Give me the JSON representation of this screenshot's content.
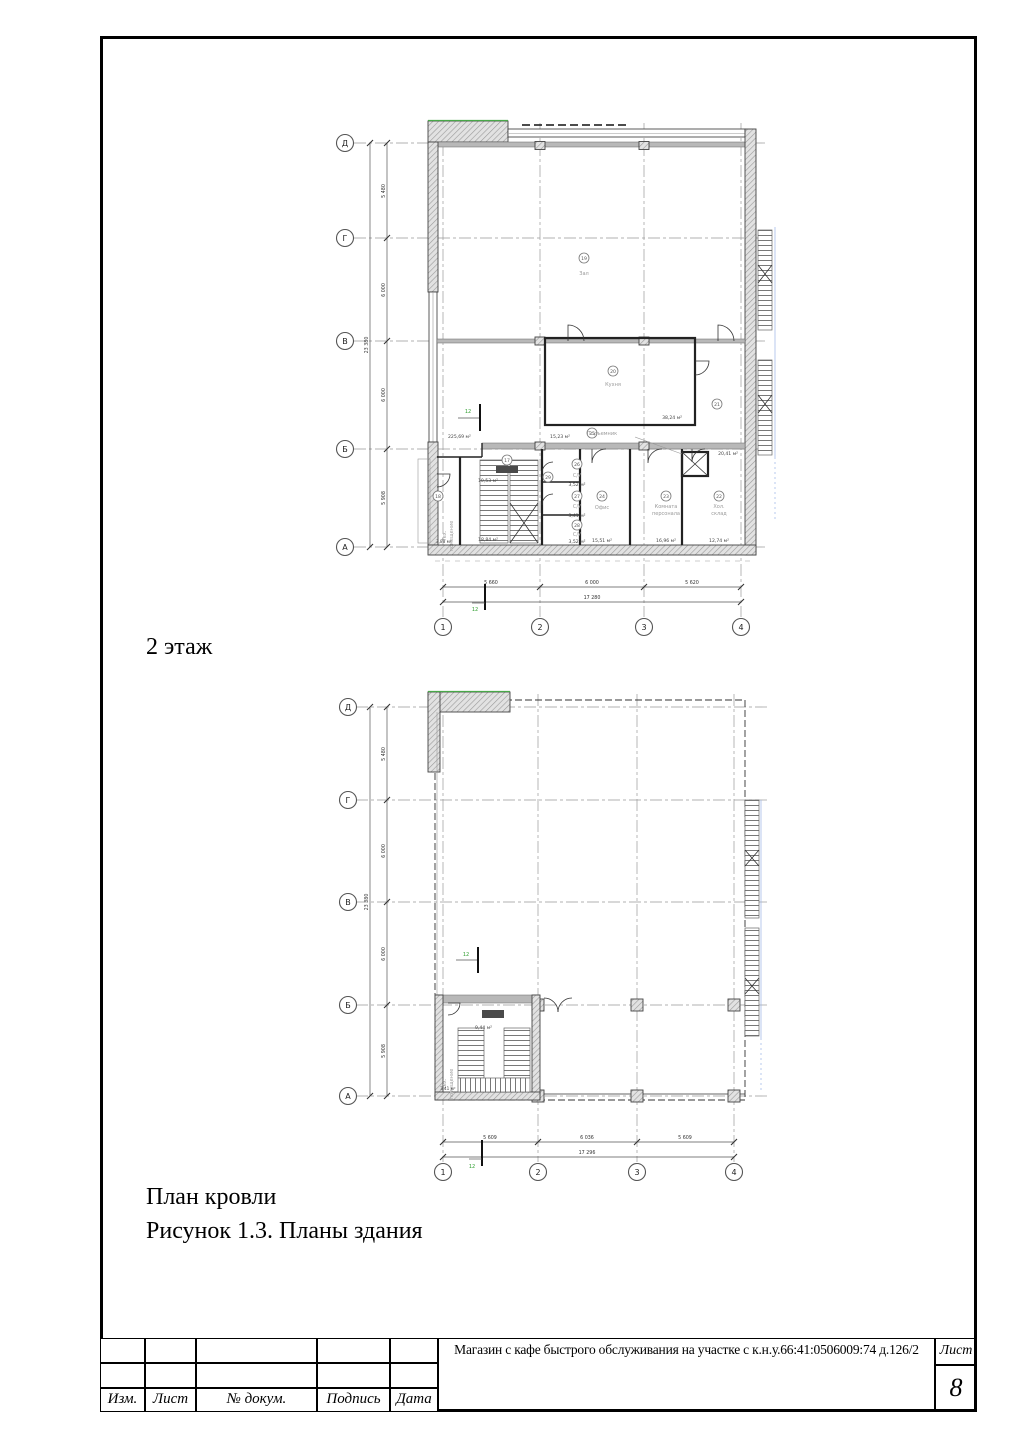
{
  "page": {
    "floor2_caption": "2 этаж",
    "roof_caption": "План кровли",
    "figure_caption": "Рисунок 1.3. Планы здания"
  },
  "title_block": {
    "col_labels": [
      "Изм.",
      "Лист",
      "№ докум.",
      "Подпись",
      "Дата"
    ],
    "project_title": "Магазин с кафе быстрого обслуживания на участке с к.н.у.66:41:0506009:74 д.126/2",
    "sheet_label": "Лист",
    "sheet_number": "8"
  },
  "floor2_plan": {
    "row_axes": [
      "Д",
      "Г",
      "В",
      "Б",
      "А"
    ],
    "col_axes": [
      "1",
      "2",
      "3",
      "4"
    ],
    "bottom_dims": [
      "5 660",
      "6 000",
      "5 620"
    ],
    "bottom_total": "17 280",
    "left_dims": [
      "5 480",
      "6 000",
      "6 000",
      "5 908"
    ],
    "left_total": "23 380",
    "section_mark": "12",
    "extra_area": "15,23 м²",
    "rooms": [
      {
        "num": "19",
        "name": "Зал",
        "area": "225,69 м²"
      },
      {
        "num": "20",
        "name": "Кухня",
        "area": "38,24 м²"
      },
      {
        "num": "21",
        "area": "20,41 м²"
      },
      {
        "num": "22",
        "name": "Хол.",
        "name2": "склад",
        "area": "12,74 м²"
      },
      {
        "num": "23",
        "name": "Комната",
        "name2": "персонала",
        "area": "16,96 м²"
      },
      {
        "num": "24",
        "name": "Офис",
        "area": "15,51 м²"
      },
      {
        "num": "25",
        "name": "Подъемник"
      },
      {
        "num": "26",
        "name": "С/У",
        "area": "3,52 м²"
      },
      {
        "num": "27",
        "name": "С/У",
        "area": "3,41 м²"
      },
      {
        "num": "28",
        "name": "С/У",
        "area": "3,52 м²"
      },
      {
        "num": "29",
        "area": "18,84 м²"
      },
      {
        "num": "17",
        "area": "10,53 м²"
      },
      {
        "num": "18",
        "name": "Тех.",
        "name2": "помещение",
        "area": "3,88 м²"
      }
    ]
  },
  "roof_plan": {
    "row_axes": [
      "Д",
      "Г",
      "В",
      "Б",
      "А"
    ],
    "col_axes": [
      "1",
      "2",
      "3",
      "4"
    ],
    "bottom_dims": [
      "5 609",
      "6 036",
      "5 609"
    ],
    "bottom_total": "17 296",
    "left_dims": [
      "5 480",
      "6 000",
      "6 000",
      "5 908"
    ],
    "left_total": "23 380",
    "section_mark": "12",
    "stair_area": "9,44 м²",
    "tech_room": {
      "name": "Тех.",
      "name2": "помещение",
      "area": "3,41 м²"
    }
  }
}
